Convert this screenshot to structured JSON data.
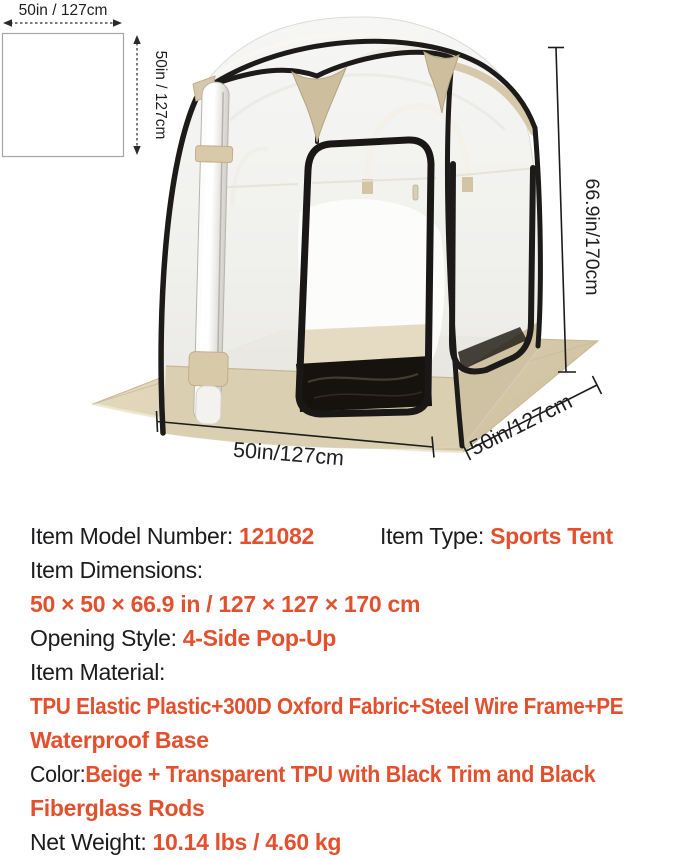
{
  "colors": {
    "accent": "#e2502d",
    "dark": "#1c1c1e",
    "beige": "#d8caab",
    "trim": "#1d1b19"
  },
  "size_diagram": {
    "top_label": "50in / 127cm",
    "side_label": "50in / 127cm"
  },
  "tent_annotations": {
    "height_label": "66.9in/170cm",
    "front_width_label": "50in/127cm",
    "side_depth_label": "50in/127cm"
  },
  "specs": {
    "model_label": "Item Model Number: ",
    "model_value": "121082",
    "type_label": "Item Type: ",
    "type_value": "Sports Tent",
    "dims_label": "Item Dimensions:",
    "dims_value": "50 × 50 × 66.9 in / 127 × 127 × 170 cm",
    "opening_label": "Opening Style: ",
    "opening_value": "4-Side Pop-Up",
    "material_label": "Item Material:",
    "material_value_line1": "TPU Elastic Plastic+300D Oxford Fabric+Steel Wire Frame+PE",
    "material_value_line2": "Waterproof Base",
    "color_label": "Color:",
    "color_value_line1": "Beige + Transparent TPU with Black Trim and Black",
    "color_value_line2": "Fiberglass Rods",
    "weight_label": "Net Weight: ",
    "weight_value": "10.14 lbs / 4.60 kg"
  }
}
